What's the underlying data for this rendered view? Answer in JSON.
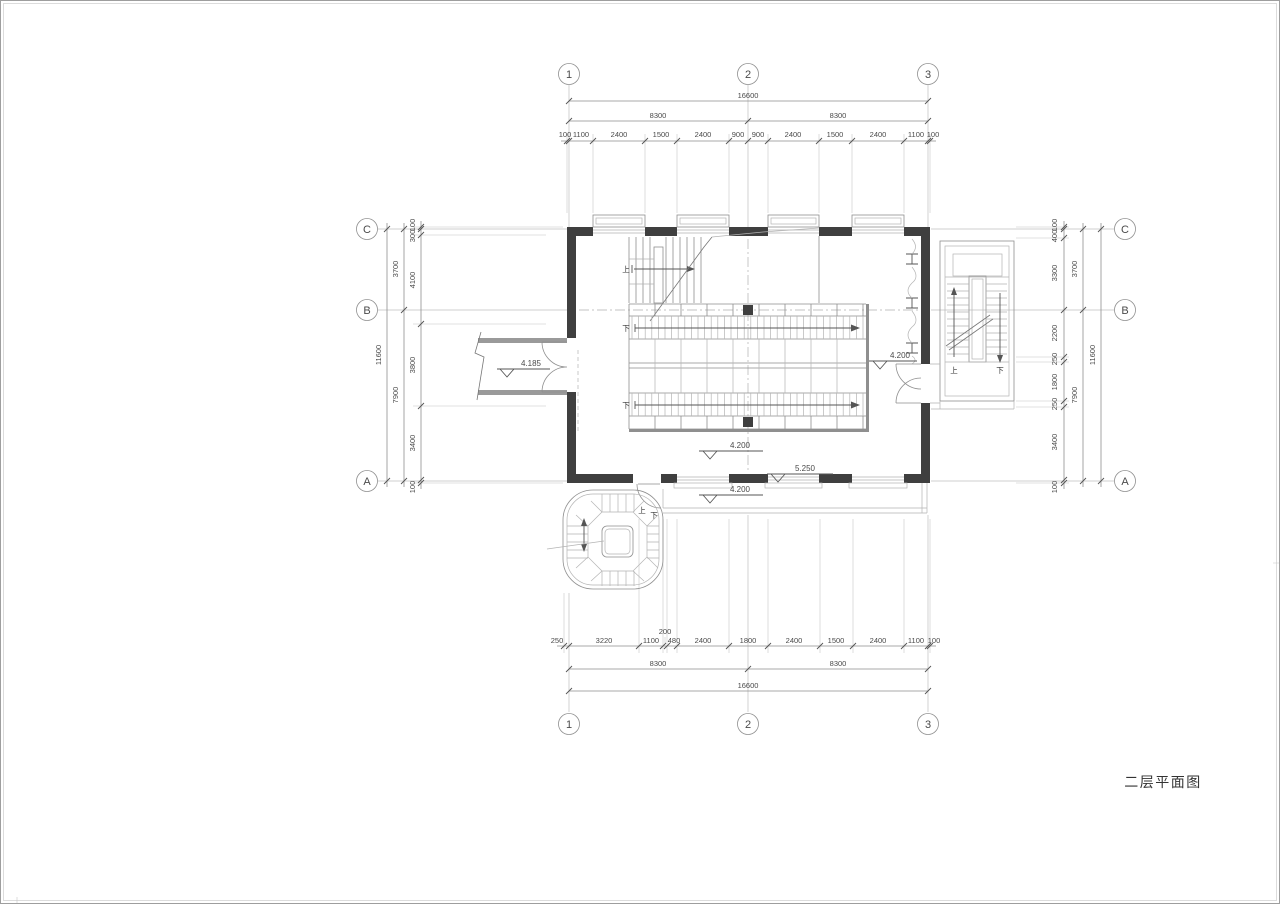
{
  "title": "二层平面图",
  "grid": {
    "top": [
      "1",
      "2",
      "3"
    ],
    "bottom": [
      "1",
      "2",
      "3"
    ],
    "left": [
      "C",
      "B",
      "A"
    ],
    "right": [
      "C",
      "B",
      "A"
    ]
  },
  "dims": {
    "top": {
      "total": "16600",
      "span_left": "8300",
      "span_right": "8300",
      "detail": [
        "100",
        "1100",
        "2400",
        "1500",
        "2400",
        "900",
        "900",
        "2400",
        "1500",
        "2400",
        "1100",
        "100"
      ]
    },
    "bottom": {
      "total": "16600",
      "span_left": "8300",
      "span_right": "8300",
      "detail": [
        "250",
        "3220",
        "1100",
        "200",
        "480",
        "2400",
        "1800",
        "2400",
        "1500",
        "2400",
        "1100",
        "100"
      ]
    },
    "left": {
      "total": "11600",
      "span_top": "3700",
      "span_bottom": "7900",
      "detail": [
        "100",
        "300",
        "4100",
        "3800",
        "3400",
        "100"
      ]
    },
    "right": {
      "total": "11600",
      "span_top": "3700",
      "span_bottom": "7900",
      "detail": [
        "100",
        "400",
        "3300",
        "2200",
        "250",
        "1800",
        "250",
        "3400",
        "100"
      ]
    }
  },
  "levels": {
    "corridor": "4.185",
    "hall": "4.200",
    "seating_right": "4.200",
    "balcony": "4.200",
    "south_window": "5.250"
  },
  "labels": {
    "up": "上",
    "down": "下"
  },
  "colors": {
    "wall": "#3f3f3f",
    "line": "#8f8f8f",
    "accent_dark": "#555"
  }
}
